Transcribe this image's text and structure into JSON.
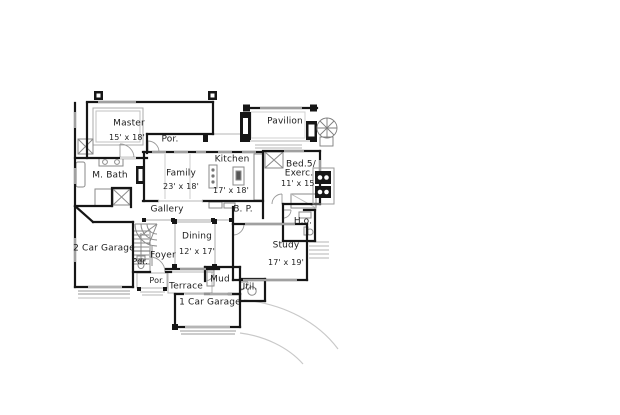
{
  "colors": {
    "wall": "#161616",
    "detail": "#8a8a8a",
    "light_detail": "#c6c6c6",
    "text": "#1c1c1c",
    "background": "#ffffff"
  },
  "symbols": [
    "fireplace-icon",
    "spiral-staircase-icon",
    "outdoor-grill-icon",
    "bathtub-icon",
    "toilet-icon",
    "closet-x-icon",
    "stairs-icon",
    "garage-door-icon",
    "driveway-icon",
    "kitchen-island-icon",
    "water-heater-icon",
    "porch-post-icon"
  ],
  "rooms": {
    "master": {
      "name": "Master",
      "dims": "15' x 18'"
    },
    "por_top": {
      "name": "Por."
    },
    "family": {
      "name": "Family",
      "dims": "23' x 18'"
    },
    "kitchen": {
      "name": "Kitchen",
      "dims": "17' x 18'"
    },
    "pavilion": {
      "name": "Pavilion"
    },
    "bed5": {
      "name": "Bed.5/",
      "name2": "Exerc.",
      "dims": "11' x 15'"
    },
    "m_bath": {
      "name": "M. Bath"
    },
    "gallery": {
      "name": "Gallery"
    },
    "butlers_pantry": {
      "name": "B. P."
    },
    "ho": {
      "name": "H.o."
    },
    "dining": {
      "name": "Dining",
      "dims": "12' x 17'"
    },
    "study": {
      "name": "Study",
      "dims": "17' x 19'"
    },
    "garage2": {
      "name": "2 Car Garage"
    },
    "foyer": {
      "name": "Foyer"
    },
    "powder": {
      "name": "Pdr."
    },
    "por_bottom": {
      "name": "Por."
    },
    "terrace": {
      "name": "Terrace"
    },
    "mud": {
      "name": "Mud"
    },
    "util": {
      "name": "Util."
    },
    "garage1": {
      "name": "1 Car Garage"
    }
  }
}
